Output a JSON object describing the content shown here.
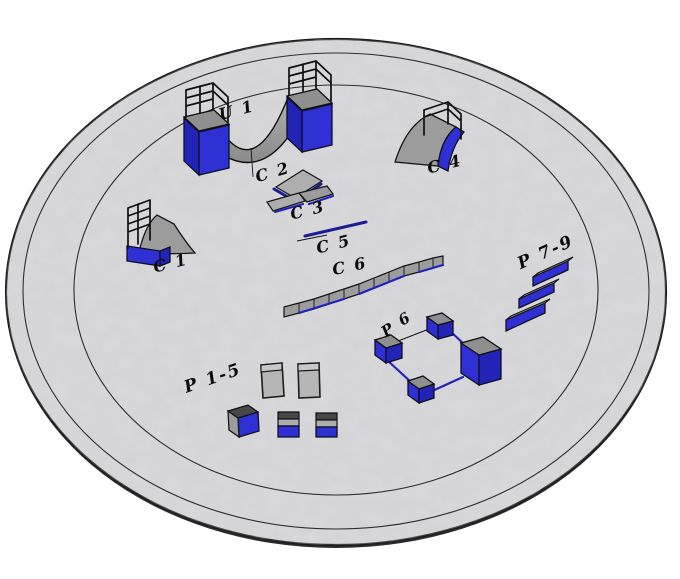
{
  "colors": {
    "background": "#ffffff",
    "ground": "#d3d3d5",
    "ground_outline": "#1c1c1c",
    "obstacle_blue": "#2e30d4",
    "obstacle_blue_dark": "#2124b6",
    "obstacle_gray": "#9c9c9c",
    "rail_navy": "#1c1c96",
    "label_color": "#0b0b0b"
  },
  "labels": {
    "u1": "U 1",
    "c1": "C 1",
    "c2": "C 2",
    "c3": "C 3",
    "c4": "C 4",
    "c5": "C 5",
    "c6": "C 6",
    "p6": "P 6",
    "p1_5": "P 1-5",
    "p7_9": "P 7-9"
  }
}
